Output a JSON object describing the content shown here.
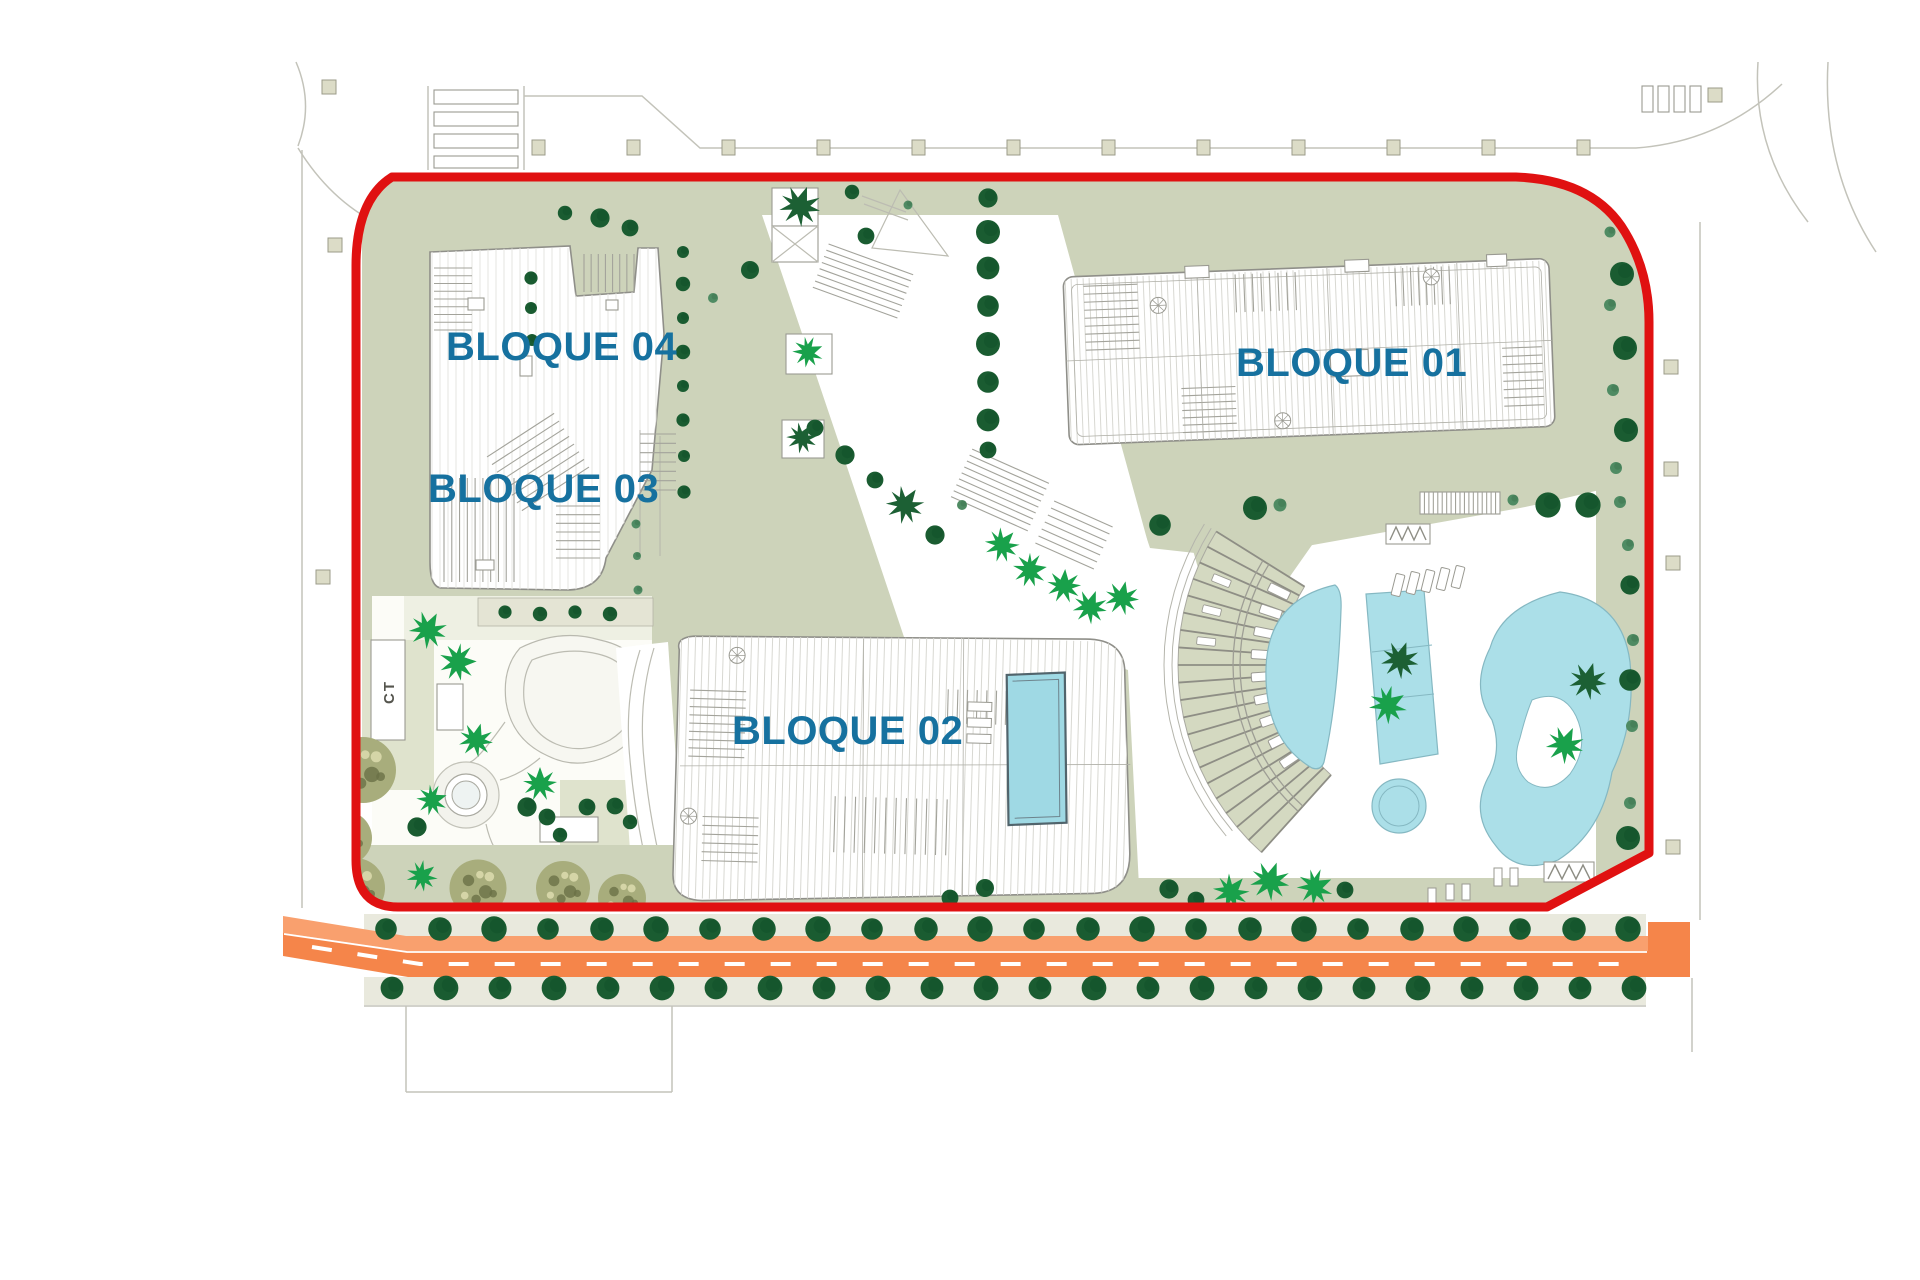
{
  "plan": {
    "type": "architectural-site-plan",
    "blocks": [
      {
        "id": "bloque-01",
        "label": "BLOQUE 01"
      },
      {
        "id": "bloque-02",
        "label": "BLOQUE 02"
      },
      {
        "id": "bloque-03",
        "label": "BLOQUE 03"
      },
      {
        "id": "bloque-04",
        "label": "BLOQUE 04"
      }
    ],
    "utility_label": "CT",
    "colors": {
      "boundary_red": "#e01111",
      "road_orange": "#f5854a",
      "road_orange_light": "#f9a06e",
      "pool_cyan": "#abdfe8",
      "label_blue": "#16719f",
      "sage_green": "#cdd3ba",
      "tree_dark_green": "#1a5c31",
      "tree_medium_green": "#4f8b63",
      "palm_green": "#19a14b",
      "mottled_olive": "#a8ad7c"
    }
  }
}
